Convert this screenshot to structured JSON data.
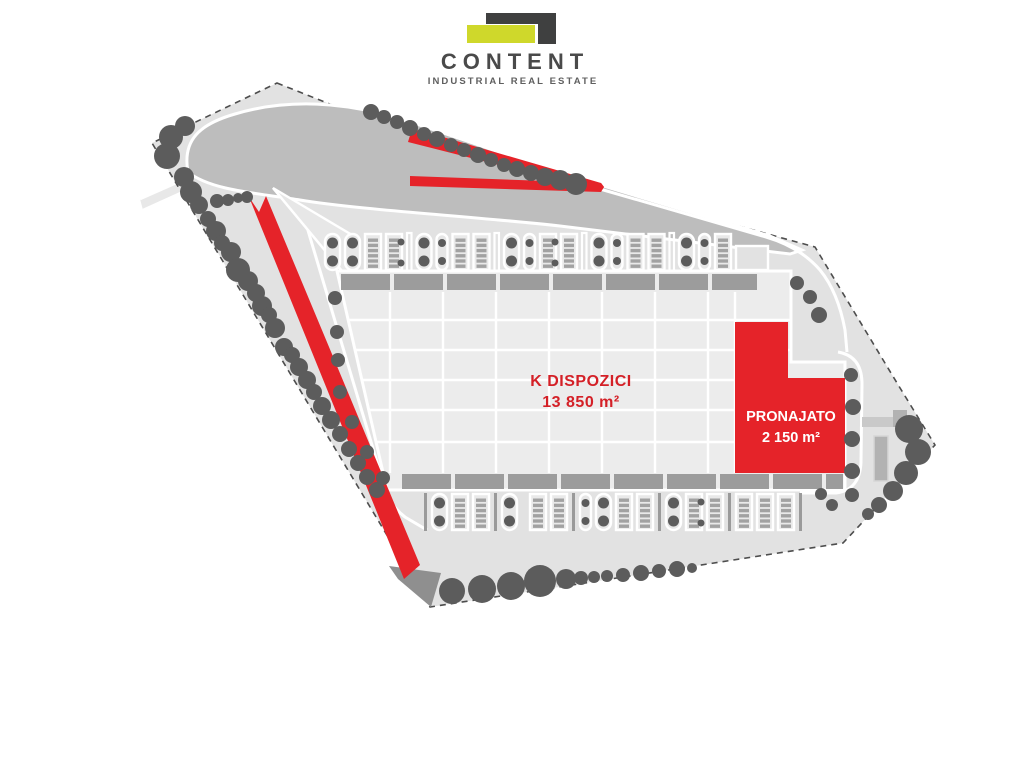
{
  "logo": {
    "title": "CONTENT",
    "subtitle": "INDUSTRIAL REAL ESTATE"
  },
  "plan": {
    "available": {
      "label": "K DISPOZICI",
      "size": "13 850 m²",
      "status": "available"
    },
    "rented": {
      "label": "PRONAJATO",
      "size": "2 150 m²",
      "status": "rented"
    }
  },
  "colors": {
    "accent_red": "#e52329",
    "label_red": "#d42027",
    "logo_dark": "#3f4040",
    "logo_yellow": "#cfd82b",
    "tree_gray": "#5c5c5c"
  }
}
